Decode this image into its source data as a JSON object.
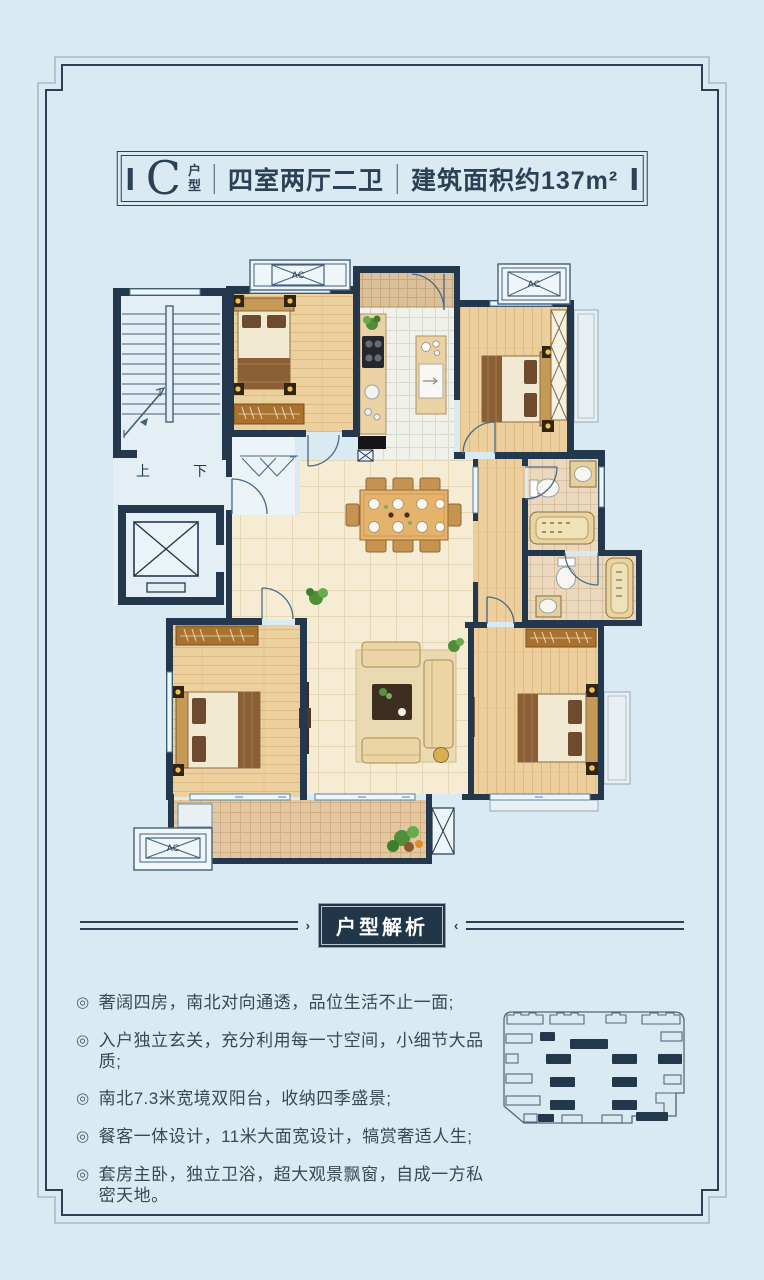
{
  "colors": {
    "background": "#d9eaf2",
    "accent_navy": "#24384d",
    "badge_bg": "#223649",
    "badge_text": "#ffffff",
    "wood_floor": "#ecd09e",
    "tile_cream": "#f5ecd3"
  },
  "title": {
    "type_letter": "C",
    "type_label": "户型",
    "rooms": "四室两厅二卫",
    "area": "建筑面积约137m²"
  },
  "plan_labels": {
    "stairs_up": "上",
    "stairs_down": "下",
    "ac": "AC"
  },
  "analysis": {
    "heading": "户型解析"
  },
  "features": {
    "bullet": "◎",
    "items": [
      "奢阔四房，南北对向通透，品位生活不止一面;",
      "入户独立玄关，充分利用每一寸空间，小细节大品质;",
      "南北7.3米宽境双阳台，收纳四季盛景;",
      "餐客一体设计，11米大面宽设计，犒赏奢适人生;",
      "套房主卧，独立卫浴，超大观景飘窗，自成一方私密天地。"
    ]
  }
}
